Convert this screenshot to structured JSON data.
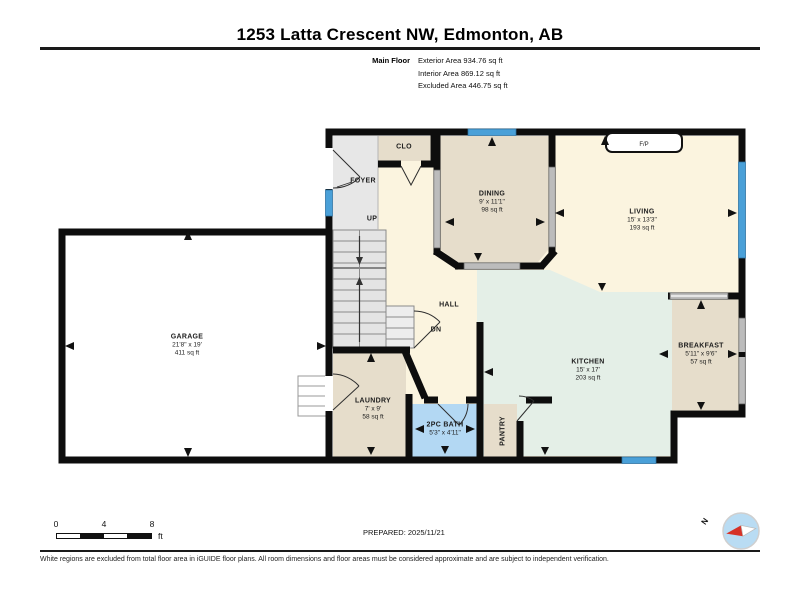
{
  "header": {
    "title": "1253 Latta Crescent NW, Edmonton, AB",
    "floor_label": "Main Floor",
    "exterior_area": "Exterior Area 934.76 sq ft",
    "interior_area": "Interior Area 869.12 sq ft",
    "excluded_area": "Excluded Area 446.75 sq ft"
  },
  "rooms": {
    "foyer": {
      "name": "FOYER"
    },
    "closet": {
      "name": "CLO"
    },
    "stairs_up": {
      "label": "UP"
    },
    "stairs_dn": {
      "label": "DN"
    },
    "hall": {
      "name": "HALL"
    },
    "dining": {
      "name": "DINING",
      "dims": "9' x 11'1\"",
      "area": "98 sq ft"
    },
    "living": {
      "name": "LIVING",
      "dims": "15' x 13'3\"",
      "area": "193 sq ft"
    },
    "kitchen": {
      "name": "KITCHEN",
      "dims": "15' x 17'",
      "area": "203 sq ft"
    },
    "breakfast": {
      "name": "BREAKFAST",
      "dims": "5'11\" x 9'6\"",
      "area": "57 sq ft"
    },
    "garage": {
      "name": "GARAGE",
      "dims": "21'8\" x 19'",
      "area": "411 sq ft"
    },
    "laundry": {
      "name": "LAUNDRY",
      "dims": "7' x 9'",
      "area": "58 sq ft"
    },
    "bath": {
      "name": "2PC BATH",
      "dims": "5'3\" x 4'11\""
    },
    "pantry": {
      "name": "PANTRY"
    },
    "fireplace": {
      "label": "F/P"
    }
  },
  "scale_bar": {
    "start": "0",
    "mid": "4",
    "end": "8",
    "unit": "ft"
  },
  "compass": {
    "north_label": "N"
  },
  "footer": {
    "prepared": "PREPARED: 2025/11/21",
    "disclaimer": "White regions are excluded from total floor area in iGUIDE floor plans. All room dimensions and floor areas must be considered approximate and are subject to independent verification."
  },
  "colors": {
    "wall": "#0d0d0d",
    "window_blue": "#4aa0d8",
    "interior_window_gray": "#bcbcbc",
    "room_cream": "#fbf4df",
    "room_tan": "#e6ddcb",
    "room_mint": "#e4efe7",
    "room_gray": "#e7e7e7",
    "bath_blue": "#b3d8f3",
    "excluded_white": "#ffffff",
    "compass_blue": "#b9dcf3",
    "compass_red": "#d63227"
  }
}
